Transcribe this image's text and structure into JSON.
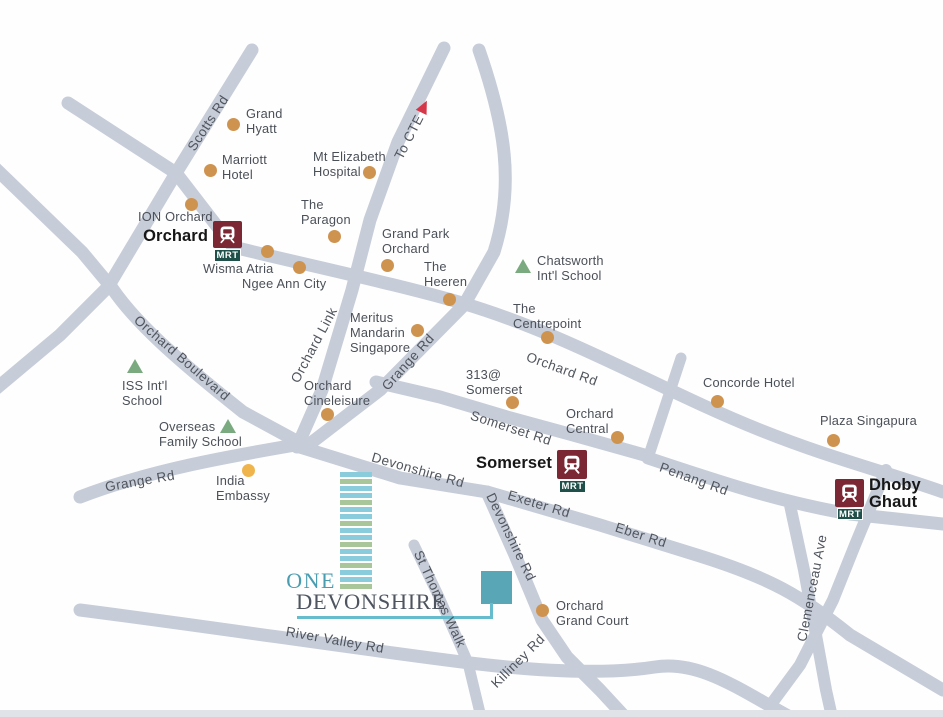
{
  "logo": {
    "one": "ONE",
    "devonshire": "DEVONSHIRE",
    "stripes": [
      "b",
      "g",
      "b",
      "b",
      "g",
      "b",
      "b",
      "g",
      "b",
      "b",
      "g",
      "b",
      "b",
      "g",
      "b",
      "b",
      "g"
    ]
  },
  "to_cte": {
    "label": "To CTE",
    "x": 409,
    "y": 137,
    "rot": -63,
    "arrow": {
      "x": 424,
      "y": 106,
      "rot": 26
    }
  },
  "road_labels": [
    {
      "text": "Scotts Rd",
      "x": 208,
      "y": 123,
      "rot": -57
    },
    {
      "text": "Orchard Boulevard",
      "x": 182,
      "y": 358,
      "rot": 41
    },
    {
      "text": "Orchard Link",
      "x": 314,
      "y": 345,
      "rot": -62
    },
    {
      "text": "Grange Rd",
      "x": 408,
      "y": 362,
      "rot": -48
    },
    {
      "text": "Grange Rd",
      "x": 140,
      "y": 481,
      "rot": -10
    },
    {
      "text": "Orchard Rd",
      "x": 562,
      "y": 369,
      "rot": 20
    },
    {
      "text": "Somerset Rd",
      "x": 511,
      "y": 428,
      "rot": 18
    },
    {
      "text": "Devonshire Rd",
      "x": 418,
      "y": 470,
      "rot": 16
    },
    {
      "text": "Exeter Rd",
      "x": 539,
      "y": 504,
      "rot": 17
    },
    {
      "text": "Eber Rd",
      "x": 641,
      "y": 535,
      "rot": 18
    },
    {
      "text": "Penang Rd",
      "x": 694,
      "y": 479,
      "rot": 20
    },
    {
      "text": "Devonshire Rd",
      "x": 511,
      "y": 537,
      "rot": 64
    },
    {
      "text": "Killiney Rd",
      "x": 518,
      "y": 661,
      "rot": -45
    },
    {
      "text": "St Thomas Walk",
      "x": 440,
      "y": 599,
      "rot": 65
    },
    {
      "text": "Clemenceau Ave",
      "x": 812,
      "y": 588,
      "rot": -79
    },
    {
      "text": "River Valley Rd",
      "x": 335,
      "y": 640,
      "rot": 10
    }
  ],
  "landmarks": [
    {
      "name": "grand-hyatt",
      "label": "Grand\nHyatt",
      "lx": 246,
      "ly": 106,
      "marker": "dot",
      "mx": 233,
      "my": 124
    },
    {
      "name": "marriott-hotel",
      "label": "Marriott\nHotel",
      "lx": 222,
      "ly": 152,
      "marker": "dot",
      "mx": 210,
      "my": 170
    },
    {
      "name": "mt-elizabeth",
      "label": "Mt Elizabeth\nHospital",
      "lx": 313,
      "ly": 149,
      "marker": "dot",
      "mx": 369,
      "my": 172
    },
    {
      "name": "ion-orchard",
      "label": "ION Orchard",
      "lx": 138,
      "ly": 209,
      "marker": "dot",
      "mx": 191,
      "my": 204
    },
    {
      "name": "the-paragon",
      "label": "The\nParagon",
      "lx": 301,
      "ly": 197,
      "marker": "dot",
      "mx": 334,
      "my": 236
    },
    {
      "name": "grand-park-orchard",
      "label": "Grand Park\nOrchard",
      "lx": 382,
      "ly": 226,
      "marker": "dot",
      "mx": 387,
      "my": 265
    },
    {
      "name": "wisma-atria",
      "label": "Wisma Atria",
      "lx": 203,
      "ly": 261,
      "marker": "dot",
      "mx": 267,
      "my": 251
    },
    {
      "name": "ngee-ann-city",
      "label": "Ngee Ann City",
      "lx": 242,
      "ly": 276,
      "marker": "dot",
      "mx": 299,
      "my": 267
    },
    {
      "name": "the-heeren",
      "label": "The\nHeeren",
      "lx": 424,
      "ly": 259,
      "marker": "dot",
      "mx": 449,
      "my": 299
    },
    {
      "name": "chatsworth-school",
      "label": "Chatsworth\nInt'l School",
      "lx": 537,
      "ly": 253,
      "marker": "triangle",
      "mx": 523,
      "my": 266
    },
    {
      "name": "meritus-mandarin",
      "label": "Meritus\nMandarin\nSingapore",
      "lx": 350,
      "ly": 310,
      "marker": "dot",
      "mx": 417,
      "my": 330
    },
    {
      "name": "the-centrepoint",
      "label": "The\nCentrepoint",
      "lx": 513,
      "ly": 301,
      "marker": "dot",
      "mx": 547,
      "my": 337
    },
    {
      "name": "313-somerset",
      "label": "313@\nSomerset",
      "lx": 466,
      "ly": 367,
      "marker": "dot",
      "mx": 512,
      "my": 402
    },
    {
      "name": "orchard-central",
      "label": "Orchard\nCentral",
      "lx": 566,
      "ly": 406,
      "marker": "dot",
      "mx": 617,
      "my": 437
    },
    {
      "name": "concorde-hotel",
      "label": "Concorde Hotel",
      "lx": 703,
      "ly": 375,
      "marker": "dot",
      "mx": 717,
      "my": 401
    },
    {
      "name": "plaza-singapura",
      "label": "Plaza Singapura",
      "lx": 820,
      "ly": 413,
      "marker": "dot",
      "mx": 833,
      "my": 440
    },
    {
      "name": "orchard-cineleisure",
      "label": "Orchard\nCineleisure",
      "lx": 304,
      "ly": 378,
      "marker": "dot",
      "mx": 327,
      "my": 414
    },
    {
      "name": "iss-school",
      "label": "ISS Int'l\nSchool",
      "lx": 122,
      "ly": 378,
      "marker": "triangle",
      "mx": 135,
      "my": 366
    },
    {
      "name": "overseas-school",
      "label": "Overseas\nFamily School",
      "lx": 159,
      "ly": 419,
      "marker": "triangle",
      "mx": 228,
      "my": 426
    },
    {
      "name": "india-embassy",
      "label": "India\nEmbassy",
      "lx": 216,
      "ly": 473,
      "marker": "dot",
      "mx": 248,
      "my": 470,
      "mcolor": "#f0b44c"
    },
    {
      "name": "orchard-grand-court",
      "label": "Orchard\nGrand Court",
      "lx": 556,
      "ly": 598,
      "marker": "dot",
      "mx": 542,
      "my": 610
    }
  ],
  "stations": [
    {
      "id": "orchard",
      "label": "Orchard",
      "tag": "MRT",
      "icon": {
        "x": 213,
        "y": 221,
        "w": 29,
        "h": 27
      },
      "tag_box": {
        "x": 214,
        "y": 249,
        "w": 27,
        "h": 13
      },
      "label_box": {
        "x": 108,
        "y": 228,
        "w": 100,
        "align": "right"
      }
    },
    {
      "id": "somerset",
      "label": "Somerset",
      "tag": "MRT",
      "icon": {
        "x": 557,
        "y": 450,
        "w": 30,
        "h": 29
      },
      "tag_box": {
        "x": 559,
        "y": 480,
        "w": 27,
        "h": 13
      },
      "label_box": {
        "x": 452,
        "y": 455,
        "w": 100,
        "align": "right"
      }
    },
    {
      "id": "dhoby-ghaut",
      "label": "Dhoby\nGhaut",
      "tag": "MRT",
      "icon": {
        "x": 835,
        "y": 479,
        "w": 29,
        "h": 28
      },
      "tag_box": {
        "x": 837,
        "y": 508,
        "w": 26,
        "h": 12
      },
      "label_box": {
        "x": 869,
        "y": 477,
        "w": 80,
        "align": "left"
      }
    }
  ],
  "colors": {
    "bg": "#fefefe",
    "road": "#c6ccd8",
    "dot": "#cf9350",
    "school": "#7baa80",
    "cte_red": "#d5374a",
    "mrt_bg": "#7c2734",
    "mrt_tag_bg": "#20504a",
    "station_text": "#171717",
    "label_text": "#4b5058",
    "road_text": "#50555d",
    "teal": "#4a9cb0",
    "teal_line": "#66bccd",
    "square": "#58a6b6",
    "stripe_blue": "#8accdb",
    "stripe_green": "#a9c69b",
    "logo_text": "#4e5560",
    "edge": "#e0e4e8"
  }
}
